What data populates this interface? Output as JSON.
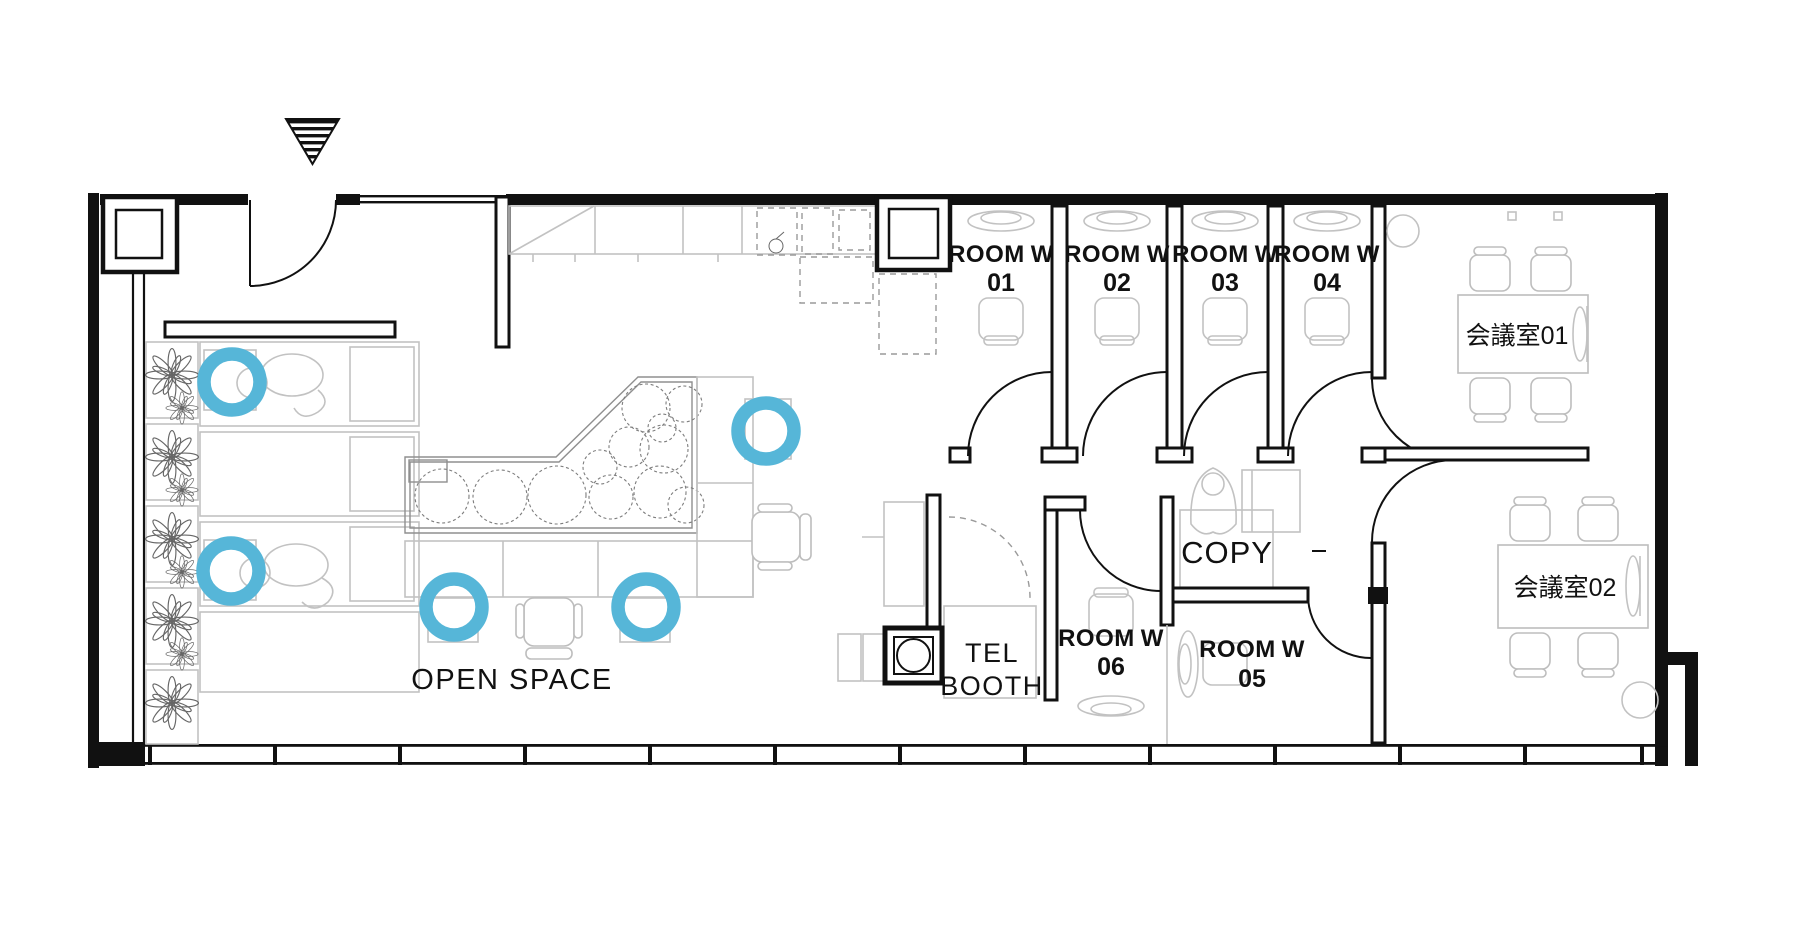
{
  "floor_plan": {
    "open_space": "OPEN SPACE",
    "tel_booth_line1": "TEL",
    "tel_booth_line2": "BOOTH",
    "copy": "COPY",
    "rooms": [
      {
        "name": "ROOM",
        "wing": "W",
        "number": "01"
      },
      {
        "name": "ROOM",
        "wing": "W",
        "number": "02"
      },
      {
        "name": "ROOM",
        "wing": "W",
        "number": "03"
      },
      {
        "name": "ROOM",
        "wing": "W",
        "number": "04"
      },
      {
        "name": "ROOM",
        "wing": "W",
        "number": "05"
      },
      {
        "name": "ROOM",
        "wing": "W",
        "number": "06"
      }
    ],
    "meeting_rooms": [
      {
        "label": "会議室01"
      },
      {
        "label": "会議室02"
      }
    ],
    "seat_markers": {
      "count": 5,
      "color": "#56B6D8"
    },
    "colors": {
      "walls": "#111111",
      "furniture": "#c2c2c2",
      "plants": "#6b6b6b"
    }
  }
}
